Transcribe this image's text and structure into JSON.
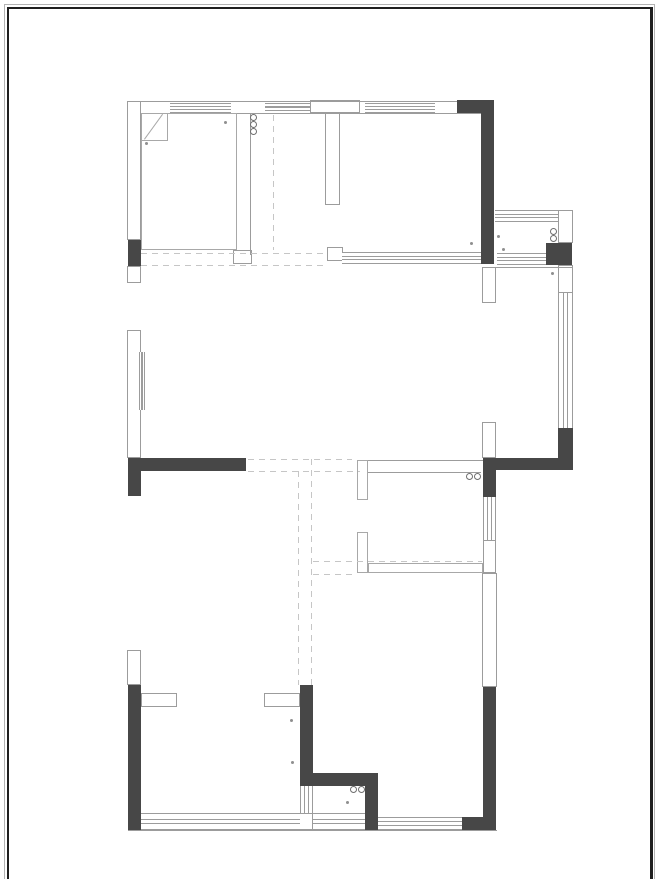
{
  "canvas": {
    "width": 660,
    "height": 879
  },
  "colors": {
    "wall": "#474747",
    "line": "#9c9c9c",
    "outline": "#a8a8a8",
    "dash": "#c6c6c6",
    "dot": "#8f8f8f",
    "circle": "#6f6f6f",
    "frame": "#1f1f1f",
    "frame-outer": "#b3b3b3"
  },
  "plan": {
    "elements": [
      {
        "t": "wall",
        "name": "wall-left-block",
        "x": 128,
        "y": 240,
        "w": 13,
        "h": 26
      },
      {
        "t": "wall",
        "name": "wall-topright-horizontal",
        "x": 457,
        "y": 100,
        "w": 37,
        "h": 13
      },
      {
        "t": "wall",
        "name": "wall-topright-vertical",
        "x": 481,
        "y": 100,
        "w": 13,
        "h": 164
      },
      {
        "t": "wall",
        "name": "wall-platform-corner",
        "x": 546,
        "y": 243,
        "w": 26,
        "h": 22
      },
      {
        "t": "wall",
        "name": "wall-midright-vertical",
        "x": 558,
        "y": 428,
        "w": 15,
        "h": 42
      },
      {
        "t": "wall",
        "name": "wall-midright-horizontal",
        "x": 483,
        "y": 458,
        "w": 90,
        "h": 12
      },
      {
        "t": "wall",
        "name": "wall-midright-step",
        "x": 483,
        "y": 458,
        "w": 13,
        "h": 39
      },
      {
        "t": "wall",
        "name": "wall-midleft-horizontal",
        "x": 128,
        "y": 458,
        "w": 118,
        "h": 13
      },
      {
        "t": "wall",
        "name": "wall-midleft-block",
        "x": 128,
        "y": 458,
        "w": 13,
        "h": 38
      },
      {
        "t": "wall",
        "name": "wall-bottomleft-vertical",
        "x": 128,
        "y": 685,
        "w": 13,
        "h": 145
      },
      {
        "t": "wall",
        "name": "wall-bottommid-vertical-1",
        "x": 300,
        "y": 685,
        "w": 13,
        "h": 90
      },
      {
        "t": "wall",
        "name": "wall-bottommid-horizontal",
        "x": 300,
        "y": 773,
        "w": 78,
        "h": 13
      },
      {
        "t": "wall",
        "name": "wall-bottommid-vertical-2",
        "x": 365,
        "y": 786,
        "w": 13,
        "h": 44
      },
      {
        "t": "wall",
        "name": "wall-bottomright-vertical",
        "x": 483,
        "y": 687,
        "w": 13,
        "h": 143
      },
      {
        "t": "wall",
        "name": "wall-bottomright-foot",
        "x": 462,
        "y": 817,
        "w": 21,
        "h": 13
      },
      {
        "t": "col",
        "name": "pier-left-top",
        "x": 127,
        "y": 101,
        "w": 14,
        "h": 139
      },
      {
        "t": "col",
        "name": "pier-left-small",
        "x": 127,
        "y": 266,
        "w": 14,
        "h": 17
      },
      {
        "t": "col",
        "name": "pier-left-mid",
        "x": 127,
        "y": 330,
        "w": 14,
        "h": 128
      },
      {
        "t": "col",
        "name": "pier-left-bottom",
        "x": 127,
        "y": 650,
        "w": 14,
        "h": 35
      },
      {
        "t": "col",
        "name": "pier-t-top",
        "x": 310,
        "y": 100,
        "w": 50,
        "h": 13
      },
      {
        "t": "col",
        "name": "pier-t-stem",
        "x": 325,
        "y": 113,
        "w": 15,
        "h": 92
      },
      {
        "t": "col",
        "name": "pier-platform-right-top",
        "x": 558,
        "y": 210,
        "w": 15,
        "h": 33
      },
      {
        "t": "col",
        "name": "pier-right-upper",
        "x": 482,
        "y": 267,
        "w": 14,
        "h": 36
      },
      {
        "t": "col",
        "name": "pier-platform-right-bottom",
        "x": 558,
        "y": 265,
        "w": 15,
        "h": 28
      },
      {
        "t": "col",
        "name": "pier-right-mid",
        "x": 482,
        "y": 422,
        "w": 14,
        "h": 36
      },
      {
        "t": "col",
        "name": "stub-wall-bottomleft",
        "x": 141,
        "y": 693,
        "w": 36,
        "h": 14
      },
      {
        "t": "col",
        "name": "stub-wall-bottommid",
        "x": 264,
        "y": 693,
        "w": 36,
        "h": 14
      },
      {
        "t": "col",
        "name": "pier-bottom-window",
        "x": 298,
        "y": 813,
        "w": 15,
        "h": 17
      },
      {
        "t": "col",
        "name": "jamb-topright-room",
        "x": 327,
        "y": 247,
        "w": 16,
        "h": 14
      },
      {
        "t": "col",
        "name": "jamb-topleft-room",
        "x": 233,
        "y": 250,
        "w": 19,
        "h": 14
      },
      {
        "t": "col",
        "name": "wall-right-segment-1",
        "x": 483,
        "y": 540,
        "w": 13,
        "h": 33
      },
      {
        "t": "col",
        "name": "wall-right-segment-2",
        "x": 482,
        "y": 573,
        "w": 15,
        "h": 114
      },
      {
        "t": "win-h",
        "name": "window-top-1",
        "x": 170,
        "y": 103,
        "w": 61,
        "h": 10
      },
      {
        "t": "win-h",
        "name": "window-top-2",
        "x": 265,
        "y": 103,
        "w": 45,
        "h": 8
      },
      {
        "t": "win-h",
        "name": "window-top-3",
        "x": 365,
        "y": 103,
        "w": 70,
        "h": 10
      },
      {
        "t": "win-h",
        "name": "window-platform-top",
        "x": 495,
        "y": 210,
        "w": 63,
        "h": 12
      },
      {
        "t": "win-h",
        "name": "window-platform-bottom",
        "x": 497,
        "y": 253,
        "w": 49,
        "h": 12
      },
      {
        "t": "win-h",
        "name": "wall-band-topright-room",
        "x": 342,
        "y": 252,
        "w": 139,
        "h": 12
      },
      {
        "t": "win-h",
        "name": "window-bottom-1",
        "x": 141,
        "y": 813,
        "w": 159,
        "h": 17
      },
      {
        "t": "win-h",
        "name": "window-bottom-2",
        "x": 313,
        "y": 813,
        "w": 52,
        "h": 17
      },
      {
        "t": "win-h",
        "name": "window-bottom-3",
        "x": 378,
        "y": 817,
        "w": 84,
        "h": 13
      },
      {
        "t": "win-v",
        "name": "window-right",
        "x": 558,
        "y": 293,
        "w": 15,
        "h": 135
      },
      {
        "t": "win-v",
        "name": "window-bath-right",
        "x": 483,
        "y": 497,
        "w": 13,
        "h": 43
      },
      {
        "t": "win-v",
        "name": "window-bottommid",
        "x": 300,
        "y": 786,
        "w": 13,
        "h": 27
      },
      {
        "t": "win-v",
        "name": "door-track-left",
        "x": 139,
        "y": 352,
        "w": 6,
        "h": 58
      },
      {
        "t": "line",
        "name": "line-top-outer",
        "x": 128,
        "y": 101,
        "w": 329,
        "h": 1
      },
      {
        "t": "line",
        "name": "line-top-inner",
        "x": 141,
        "y": 113,
        "w": 340,
        "h": 1
      },
      {
        "t": "line",
        "name": "line-platform-bottom",
        "x": 483,
        "y": 267,
        "w": 90,
        "h": 1
      },
      {
        "t": "line",
        "name": "line-mid-boundary",
        "x": 357,
        "y": 460,
        "w": 126,
        "h": 1
      },
      {
        "t": "line",
        "name": "line-bath-top",
        "x": 368,
        "y": 472,
        "w": 113,
        "h": 1
      },
      {
        "t": "line",
        "name": "line-bottom-outer",
        "x": 128,
        "y": 830,
        "w": 369,
        "h": 1
      },
      {
        "t": "line",
        "name": "line-roomB-left",
        "x": 250,
        "y": 113,
        "w": 1,
        "h": 142
      },
      {
        "t": "room",
        "name": "room-topleft-outline",
        "x": 141,
        "y": 113,
        "w": 96,
        "h": 137
      },
      {
        "t": "roomw",
        "name": "bath-bottom-wall",
        "x": 368,
        "y": 563,
        "w": 115,
        "h": 10
      },
      {
        "t": "roomw",
        "name": "bath-jamb-upper",
        "x": 357,
        "y": 460,
        "w": 11,
        "h": 40
      },
      {
        "t": "roomw",
        "name": "bath-jamb-lower",
        "x": 357,
        "y": 532,
        "w": 11,
        "h": 41
      },
      {
        "t": "room",
        "name": "door-leaf-box",
        "x": 141,
        "y": 113,
        "w": 27,
        "h": 28
      },
      {
        "t": "diag",
        "name": "door-leaf-diagonal",
        "x": 144,
        "y": 139,
        "w": 31,
        "h": 1,
        "rot": -54
      },
      {
        "t": "dash-h",
        "name": "hidden-line-top-1",
        "x": 141,
        "y": 253,
        "w": 187,
        "h": 1
      },
      {
        "t": "dash-h",
        "name": "hidden-line-top-2",
        "x": 141,
        "y": 265,
        "w": 187,
        "h": 1
      },
      {
        "t": "dash-v",
        "name": "hidden-line-roomB",
        "x": 273,
        "y": 115,
        "w": 1,
        "h": 135
      },
      {
        "t": "dash-h",
        "name": "hidden-line-mid-1",
        "x": 248,
        "y": 459,
        "w": 104,
        "h": 1
      },
      {
        "t": "dash-h",
        "name": "hidden-line-mid-2",
        "x": 248,
        "y": 471,
        "w": 112,
        "h": 1
      },
      {
        "t": "dash-v",
        "name": "hidden-line-vert-1",
        "x": 298,
        "y": 471,
        "w": 1,
        "h": 214
      },
      {
        "t": "dash-v",
        "name": "hidden-line-vert-2",
        "x": 311,
        "y": 459,
        "w": 1,
        "h": 226
      },
      {
        "t": "dash-h",
        "name": "hidden-line-bath-1",
        "x": 313,
        "y": 561,
        "w": 169,
        "h": 1
      },
      {
        "t": "dash-h",
        "name": "hidden-line-bath-2",
        "x": 313,
        "y": 574,
        "w": 44,
        "h": 1
      },
      {
        "t": "circle",
        "name": "fixture-circle",
        "x": 250,
        "y": 114,
        "w": 7,
        "h": 7
      },
      {
        "t": "circle",
        "name": "fixture-circle",
        "x": 250,
        "y": 121,
        "w": 7,
        "h": 7
      },
      {
        "t": "circle",
        "name": "fixture-circle",
        "x": 250,
        "y": 128,
        "w": 7,
        "h": 7
      },
      {
        "t": "circle",
        "name": "fixture-circle",
        "x": 550,
        "y": 228,
        "w": 7,
        "h": 7
      },
      {
        "t": "circle",
        "name": "fixture-circle",
        "x": 550,
        "y": 235,
        "w": 7,
        "h": 7
      },
      {
        "t": "circle",
        "name": "fixture-circle",
        "x": 466,
        "y": 473,
        "w": 7,
        "h": 7
      },
      {
        "t": "circle",
        "name": "fixture-circle",
        "x": 474,
        "y": 473,
        "w": 7,
        "h": 7
      },
      {
        "t": "circle",
        "name": "fixture-circle",
        "x": 350,
        "y": 786,
        "w": 7,
        "h": 7
      },
      {
        "t": "circle",
        "name": "fixture-circle",
        "x": 358,
        "y": 786,
        "w": 7,
        "h": 7
      },
      {
        "t": "dot",
        "name": "marker-dot",
        "x": 145,
        "y": 142,
        "w": 3,
        "h": 3
      },
      {
        "t": "dot",
        "name": "marker-dot",
        "x": 224,
        "y": 121,
        "w": 3,
        "h": 3
      },
      {
        "t": "dot",
        "name": "marker-dot",
        "x": 470,
        "y": 242,
        "w": 3,
        "h": 3
      },
      {
        "t": "dot",
        "name": "marker-dot",
        "x": 497,
        "y": 235,
        "w": 3,
        "h": 3
      },
      {
        "t": "dot",
        "name": "marker-dot",
        "x": 502,
        "y": 248,
        "w": 3,
        "h": 3
      },
      {
        "t": "dot",
        "name": "marker-dot",
        "x": 551,
        "y": 272,
        "w": 3,
        "h": 3
      },
      {
        "t": "dot",
        "name": "marker-dot",
        "x": 290,
        "y": 719,
        "w": 3,
        "h": 3
      },
      {
        "t": "dot",
        "name": "marker-dot",
        "x": 291,
        "y": 761,
        "w": 3,
        "h": 3
      },
      {
        "t": "dot",
        "name": "marker-dot",
        "x": 346,
        "y": 801,
        "w": 3,
        "h": 3
      }
    ]
  }
}
